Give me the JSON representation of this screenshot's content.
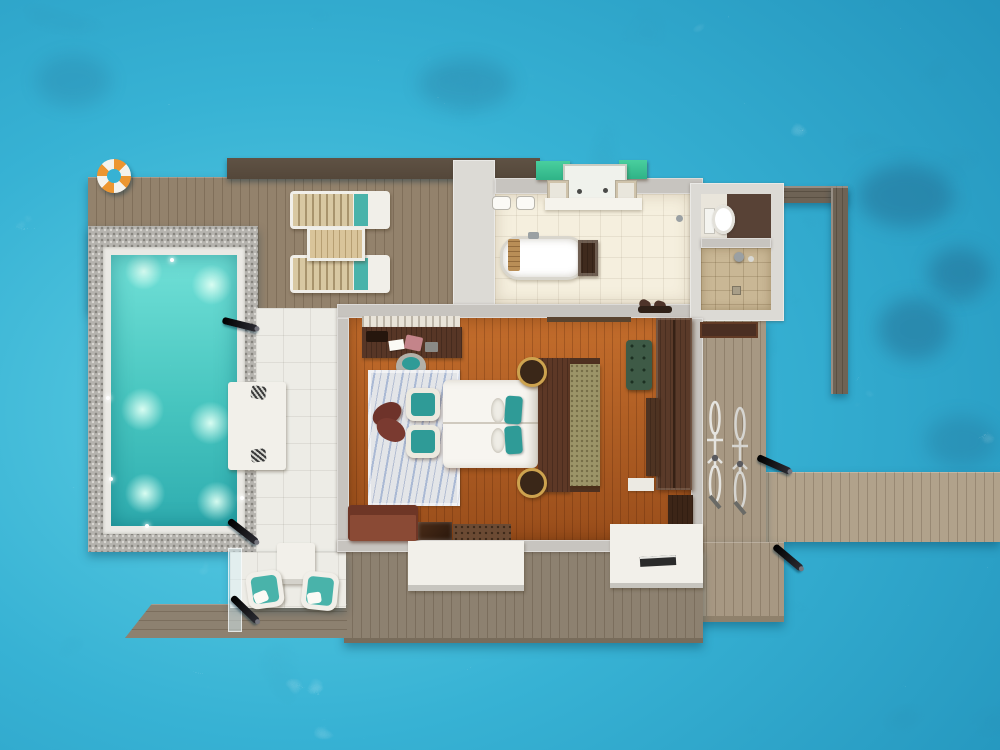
{
  "page": {
    "title": "Overwater pool villa - top-down 3D floor plan render"
  },
  "colors": {
    "ocean-light": "#5fd0e4",
    "ocean-mid": "#37b2d4",
    "ocean-deep": "#2191ba",
    "pool-a": "#71e0d7",
    "pool-b": "#47c5bf",
    "pool-c": "#2fadb0",
    "pool-glow": "#d8fdf2",
    "pebble": "#b5b3ae",
    "pebble-dot": "#87857f",
    "pebble-light": "#d9d7d2",
    "coping": "#eae9e4",
    "deck-main": "#93826c",
    "deck-south": "#8d8170",
    "deck-entry": "#a79883",
    "walkway": "#b1a28b",
    "plank-line": "rgba(50,35,18,0.20)",
    "roof": "#54473a",
    "wall": "#c7c4bf",
    "wall-light": "#dcdad5",
    "wall-wood": "#6e6355",
    "terrace": "#edece6",
    "bath-floor": "#f5efde",
    "floor-a": "#c36d2c",
    "floor-b": "#9a4e1b",
    "wood-dark": "#573626",
    "wood-darker": "#36210f",
    "teal": "#2f9b97",
    "teal-soft": "#49b3aa",
    "white-soft": "#f2f0ea",
    "green-canopy": "#2fb387",
    "bench-green": "#3e5a46",
    "sofa": "#8a4a35",
    "sofa-dark": "#6e3626",
    "runner": "#9c9468",
    "rug": "#e3e5e8",
    "rug-blue": "#7b95c4",
    "slat": "#d8c8a2",
    "tan": "#d9c49a",
    "ring": "#ec9631",
    "torch": "#141418",
    "shower-tile": "#c9b795",
    "wc-dark": "#584236",
    "mat": "#4a2e22",
    "pink": "#c4848a",
    "glass": "rgba(216,240,246,0.5)",
    "chrome": "#9aa0a3"
  },
  "inventory": {
    "pool": {
      "underwater_lights": 6,
      "in_pool_daybed": 1,
      "daybed_pillows": 2,
      "glass_balustrade_panels": 1
    },
    "sun_deck": {
      "sun_loungers": 2,
      "lounger_side_table": 1,
      "life_ring": 1
    },
    "terrace": {
      "armchairs": 2,
      "coffee_table": 1
    },
    "bedroom": {
      "double_bed": 1,
      "teal_pillows": 2,
      "white_pillows": 2,
      "armchairs": 2,
      "writing_desk": 1,
      "desk_chair": 1,
      "area_rug": 1,
      "wardrobe": 1,
      "green_bench": 1,
      "sofa": 1,
      "media_console_units": 3,
      "bedside_lamps": 2
    },
    "bathroom": {
      "freestanding_bathtub": 1,
      "vanity_with_green_canopy": 1,
      "wc_room": 1,
      "shower_room": 1,
      "slippers_pairs": 1
    },
    "exterior": {
      "bicycles": 2,
      "deck_torches": 5,
      "jetty_walkway": 1,
      "privacy_wall": 1,
      "entry_landings": 2,
      "entry_mat": 1
    }
  }
}
